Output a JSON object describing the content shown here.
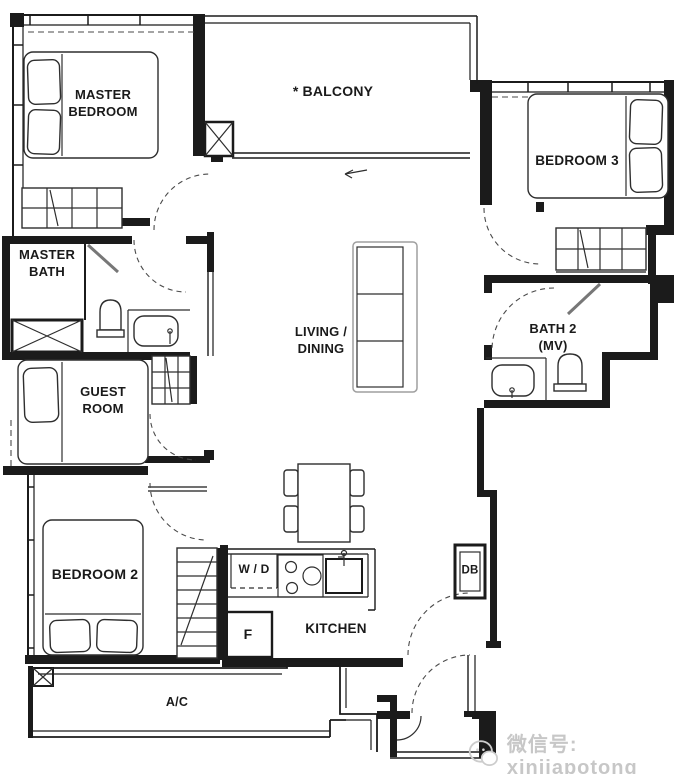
{
  "colors": {
    "wall": "#1b1b1b",
    "line": "#2e2e2e",
    "light": "#9f9f9f",
    "dashed": "#4a4a4a",
    "watermark": "#c7c7c7",
    "bg": "#ffffff"
  },
  "rooms": {
    "master_bedroom": {
      "label": "MASTER\nBEDROOM"
    },
    "balcony": {
      "label": "* BALCONY"
    },
    "bedroom_3": {
      "label": "BEDROOM 3"
    },
    "master_bath": {
      "label": "MASTER\nBATH"
    },
    "living_dining": {
      "label": "LIVING  /\nDINING"
    },
    "bath_2": {
      "label": "BATH 2\n(MV)"
    },
    "guest_room": {
      "label": "GUEST\nROOM"
    },
    "bedroom_2": {
      "label": "BEDROOM 2"
    },
    "kitchen": {
      "label": "KITCHEN"
    }
  },
  "fixtures": {
    "washer_dryer": {
      "label": "W / D"
    },
    "fridge": {
      "label": "F"
    },
    "distribution_board": {
      "label": "DB"
    },
    "ac_ledge": {
      "label": "A/C"
    }
  },
  "watermark": {
    "icon": "wechat-icon",
    "text": "微信号: xinjiapotong"
  }
}
